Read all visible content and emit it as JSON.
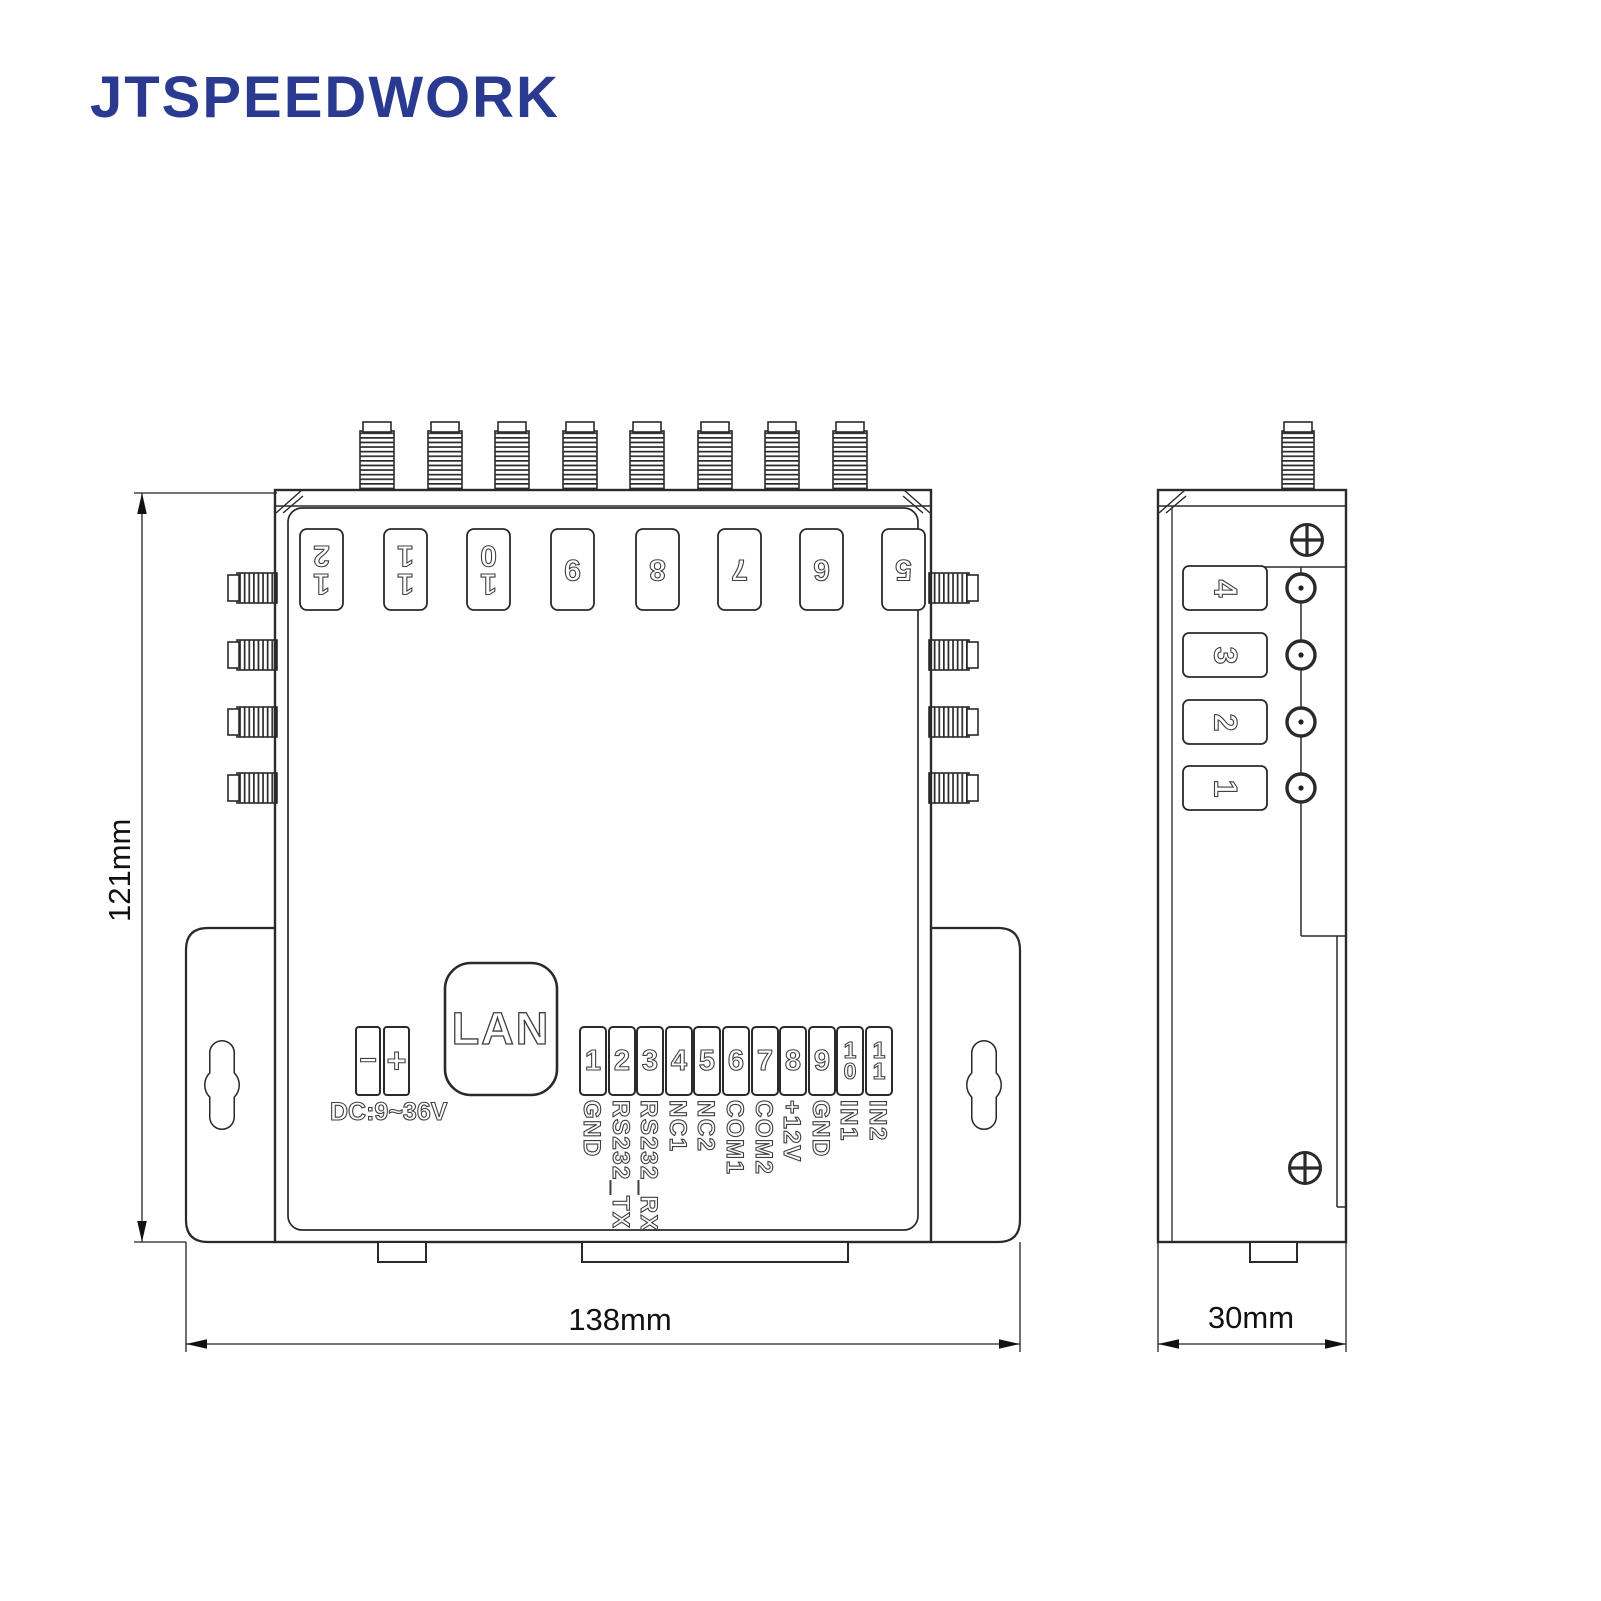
{
  "brand": {
    "logo_text": "JTSPEEDWORK"
  },
  "front_view": {
    "top_port_labels": [
      "1\n2",
      "1\n1",
      "1\n0",
      "9",
      "8",
      "7",
      "6",
      "5"
    ],
    "power": {
      "minus_label": "−",
      "plus_label": "+",
      "voltage_label": "DC:9~36V"
    },
    "lan_label": "LAN",
    "terminal_pins": [
      {
        "num": "1",
        "label": "GND"
      },
      {
        "num": "2",
        "label": "RS232_TX"
      },
      {
        "num": "3",
        "label": "RS232_RX"
      },
      {
        "num": "4",
        "label": "NC1"
      },
      {
        "num": "5",
        "label": "NC2"
      },
      {
        "num": "6",
        "label": "COM1"
      },
      {
        "num": "7",
        "label": "COM2"
      },
      {
        "num": "8",
        "label": "+12V"
      },
      {
        "num": "9",
        "label": "GND"
      },
      {
        "num": "1\n0",
        "label": "IN1"
      },
      {
        "num": "1\n1",
        "label": "IN2"
      }
    ],
    "width_dimension": "138mm",
    "height_dimension": "121mm"
  },
  "side_view": {
    "port_labels": [
      "4",
      "3",
      "2",
      "1"
    ],
    "width_dimension": "30mm"
  },
  "colors": {
    "logo": "#2b3a91",
    "line": "#2a2a2a"
  }
}
